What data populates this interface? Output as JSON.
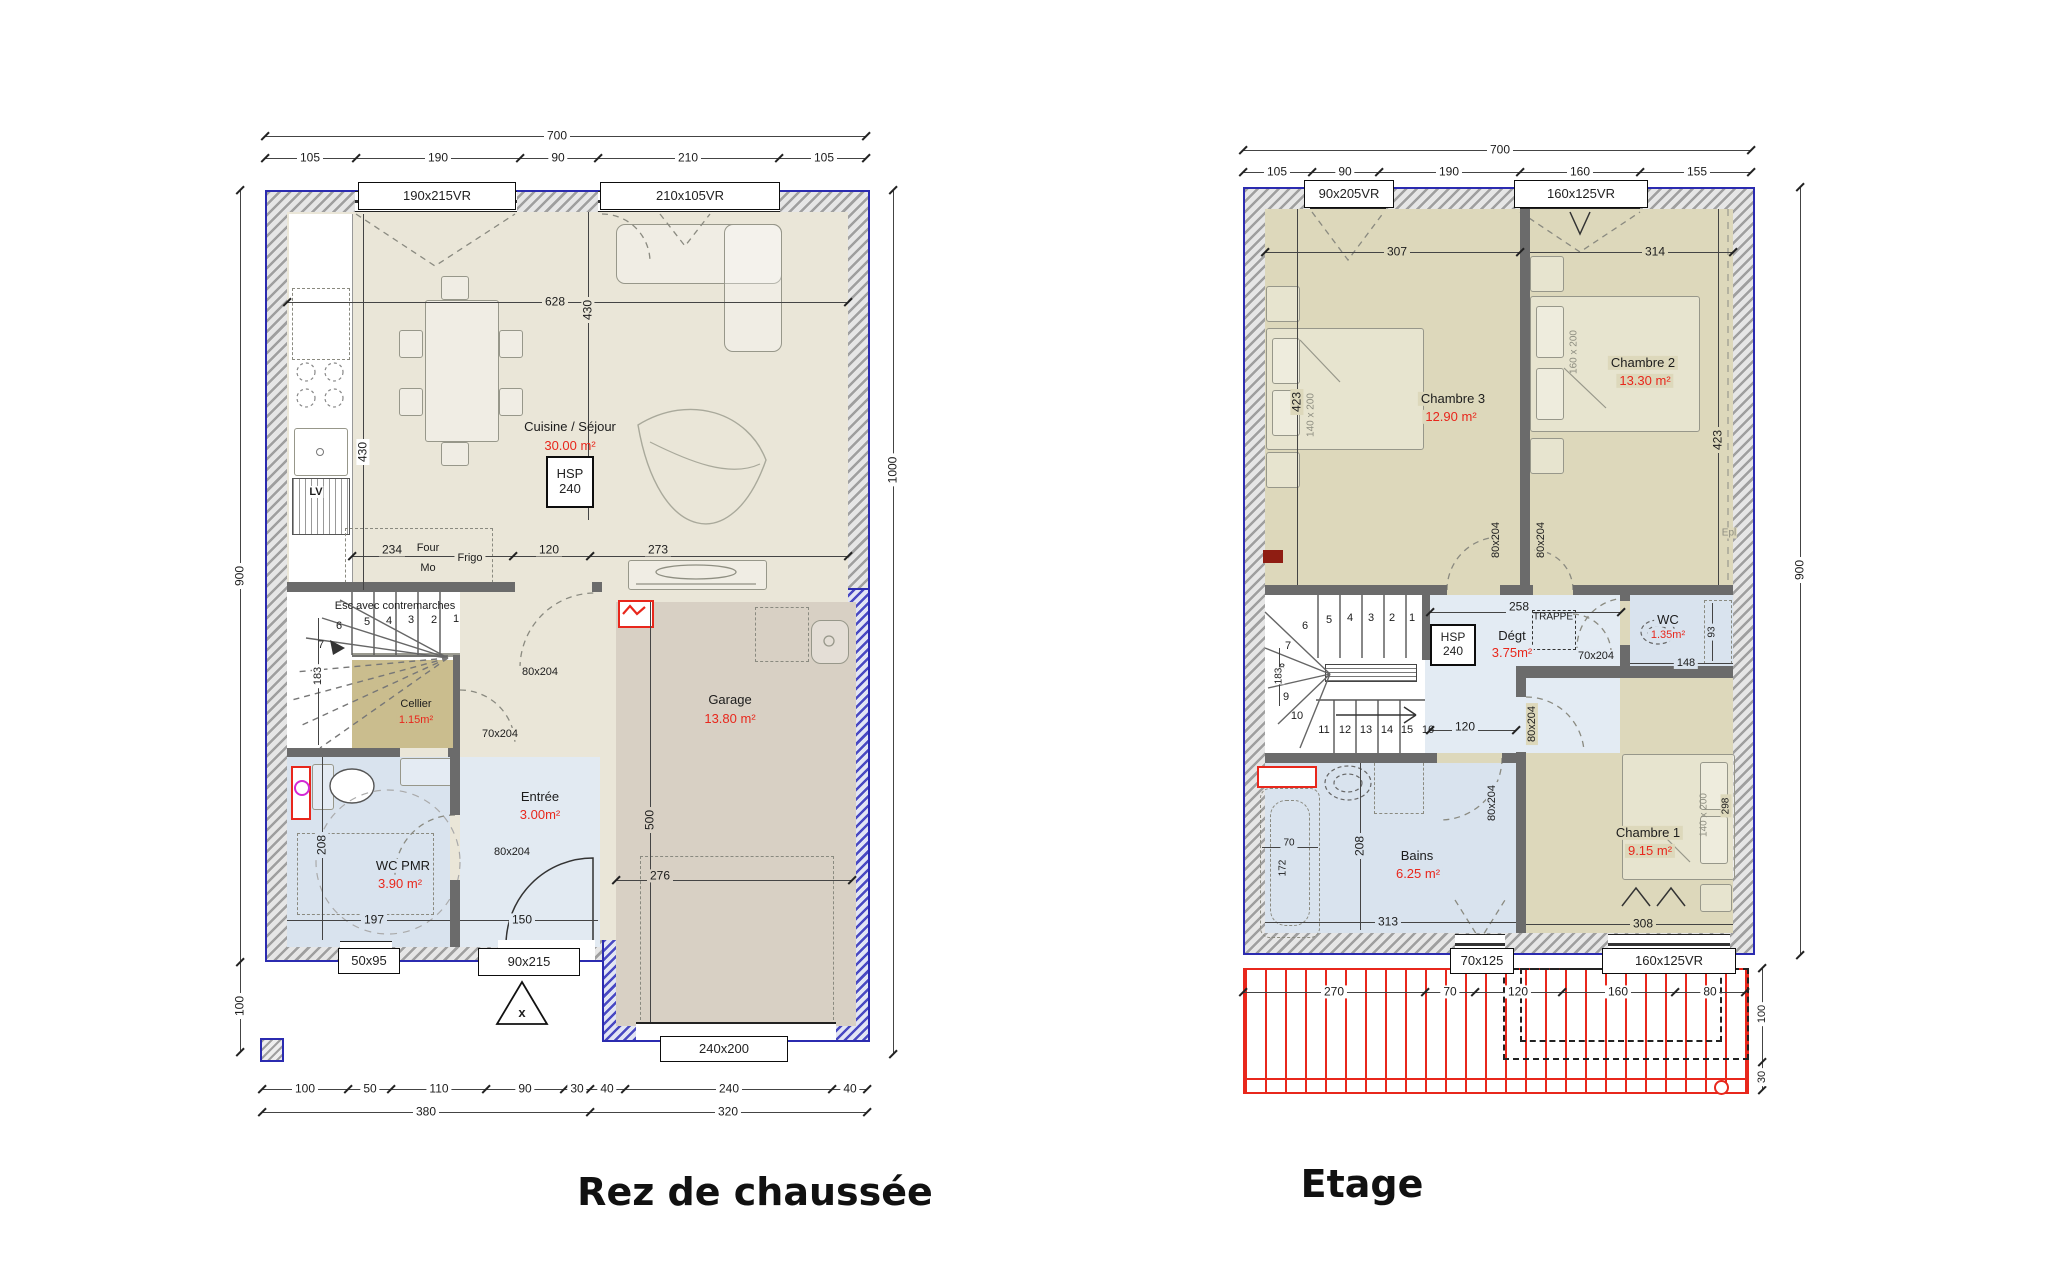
{
  "titles": {
    "ground": "Rez de chaussée",
    "floor": "Etage"
  },
  "colors": {
    "outline_blue": "#2b2bb0",
    "area_red": "#e8271c",
    "beige": "#eae6d8",
    "olive": "#ddd8bb",
    "wet_blue": "#d9e3ee",
    "khaki": "#cabd8e",
    "garage_tan": "#d8d0c4",
    "terrace_red": "#e8271c"
  },
  "ground": {
    "dim_total_top": "700",
    "dims_top": [
      "105",
      "190",
      "90",
      "210",
      "105"
    ],
    "win_top": [
      "190x215VR",
      "210x105VR"
    ],
    "dim_left": "900",
    "dim_left_low": "100",
    "dim_right": "1000",
    "dim_628": "628",
    "dim_430_kitchen": "430",
    "dim_430_sejour": "430",
    "dim_234": "234",
    "lbl_four": "Four",
    "lbl_mo": "Mo",
    "lbl_frigo": "Frigo",
    "lbl_lv": "LV",
    "dim_120": "120",
    "dim_273": "273",
    "room": "Cuisine / Séjour",
    "room_area": "30.00 m²",
    "hsp1": "HSP",
    "hsp2": "240",
    "stairs_label": "Esc avec contremarches",
    "stairs_steps": [
      "1",
      "2",
      "3",
      "4",
      "5",
      "6",
      "7"
    ],
    "dim_183": "183",
    "cellier": "Cellier",
    "cellier_area": "1.15m²",
    "garage": "Garage",
    "garage_area": "13.80 m²",
    "dim_500": "500",
    "dim_276": "276",
    "garage_door": "240x200",
    "entree": "Entrée",
    "entree_area": "3.00m²",
    "wcpmr": "WC PMR",
    "wcpmr_area": "3.90 m²",
    "dim_208": "208",
    "dim_197": "197",
    "dim_150": "150",
    "door_garage": "80x204",
    "door_cellier": "70x204",
    "door_wc": "80x204",
    "door_front": "90x215",
    "front_mark": "x",
    "win_wc": "50x95",
    "dims_bottom": [
      "100",
      "50",
      "110",
      "90",
      "30",
      "40",
      "240",
      "40"
    ],
    "dim_380": "380",
    "dim_320": "320"
  },
  "floor": {
    "dim_total_top": "700",
    "dims_top": [
      "105",
      "90",
      "190",
      "160",
      "155"
    ],
    "win_top": [
      "90x205VR",
      "160x125VR"
    ],
    "dim_right": "900",
    "dim_100": "100",
    "dim_30": "30",
    "ch3": "Chambre 3",
    "ch3_area": "12.90 m²",
    "dim_307": "307",
    "dim_423_l": "423",
    "bed3": "140 x 200",
    "ch2": "Chambre 2",
    "ch2_area": "13.30 m²",
    "dim_314": "314",
    "dim_423_r": "423",
    "bed2": "160 x 200",
    "epl": "Epl",
    "stairs_steps": [
      "1",
      "2",
      "3",
      "4",
      "5",
      "6",
      "7",
      "8",
      "9",
      "10",
      "11",
      "12",
      "13",
      "14",
      "15",
      "16"
    ],
    "dim_183": "183",
    "hsp1": "HSP",
    "hsp2": "240",
    "degt": "Dégt",
    "degt_area": "3.75m²",
    "dim_258": "258",
    "trappe": "TRAPPE",
    "dim_120": "120",
    "door_ch3": "80x204",
    "door_ch2": "80x204",
    "door_ch1": "80x204",
    "door_bains": "80x204",
    "door_wc": "70x204",
    "wc": "WC",
    "wc_area": "1.35m²",
    "dim_148": "148",
    "dim_93": "93",
    "bains": "Bains",
    "bains_area": "6.25 m²",
    "dim_208": "208",
    "dim_313": "313",
    "dim_70": "70",
    "dim_172": "172",
    "ch1": "Chambre 1",
    "ch1_area": "9.15 m²",
    "dim_308": "308",
    "dim_298": "298",
    "bed1": "140 x 200",
    "win_bottom": [
      "70x125",
      "160x125VR"
    ],
    "dims_bottom": [
      "270",
      "70",
      "120",
      "160",
      "80"
    ]
  }
}
